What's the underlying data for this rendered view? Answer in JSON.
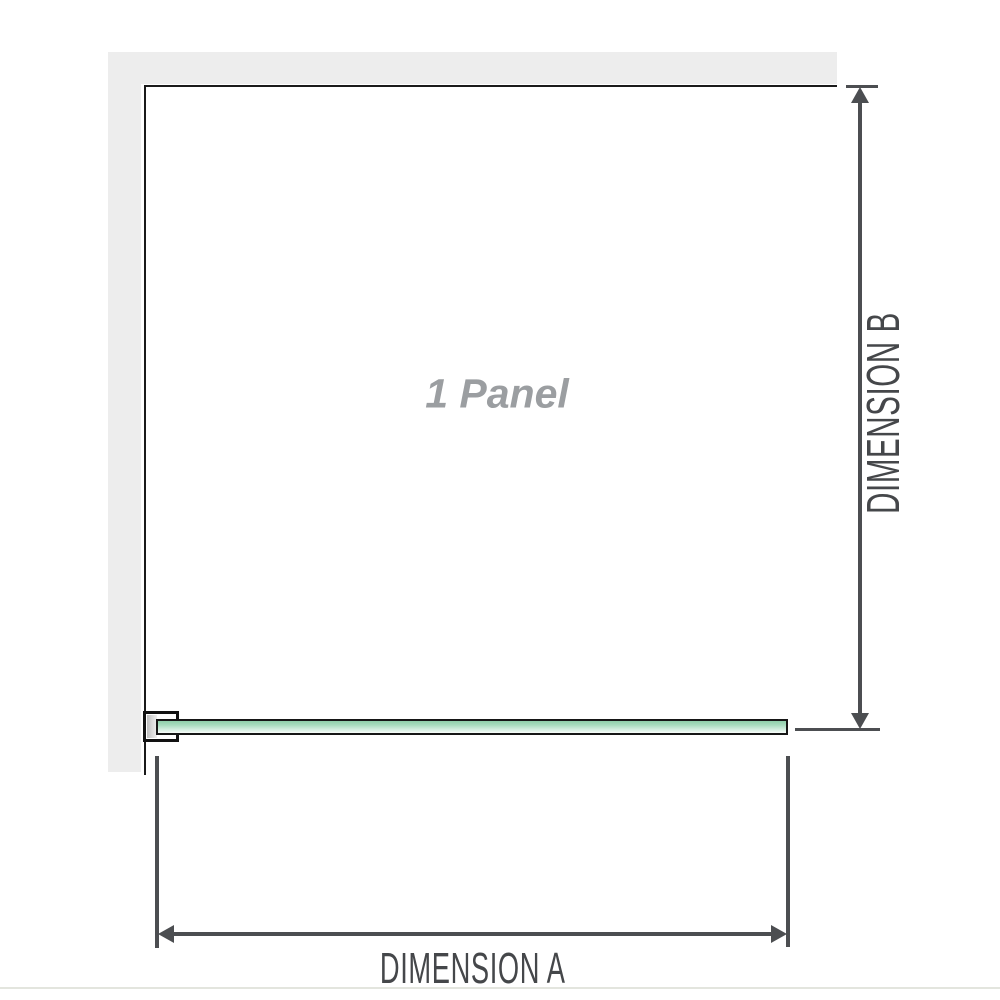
{
  "diagram": {
    "panel_label": "1 Panel",
    "dimension_a": {
      "label": "DIMENSION A"
    },
    "dimension_b": {
      "label": "DIMENSION B"
    },
    "colors": {
      "wall": "#ededed",
      "panel_outline": "#1a1a1a",
      "glass_green_dark": "#8ecfa9",
      "glass_green_light": "#f9fdfb",
      "glass_border": "#161616",
      "bracket_border": "#121212",
      "bracket_insert_silver": "#bdbdbd",
      "dimension_lines": "#4c4e51",
      "dimension_label_text": "#45474a",
      "panel_label_text": "#9b9ea1",
      "bottom_divider": "#e3e5de",
      "background": "#ffffff"
    }
  }
}
